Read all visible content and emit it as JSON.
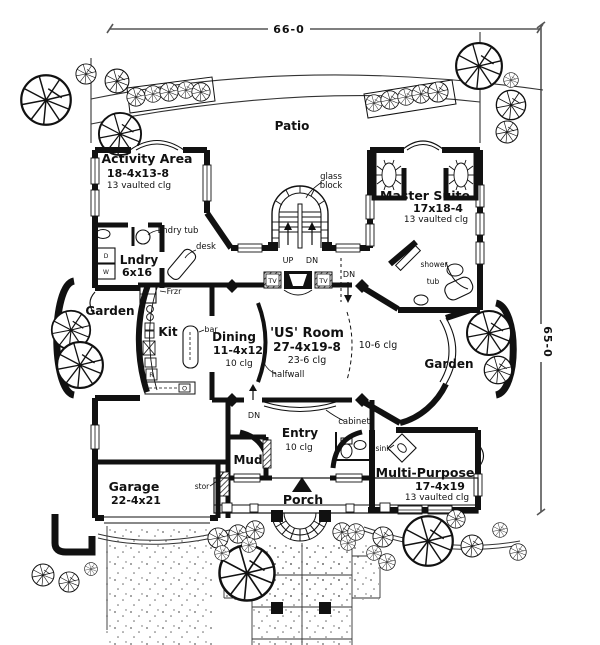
{
  "dimensions": {
    "top": "66-0",
    "right": "65-0"
  },
  "site": {
    "patio": "Patio"
  },
  "rooms": {
    "activity": {
      "name": "Activity Area",
      "size": "18-4x13-8",
      "ceiling": "13 vaulted clg"
    },
    "master": {
      "name": "Master Suite",
      "size": "17x18-4",
      "ceiling": "13 vaulted clg"
    },
    "lndry": {
      "name": "Lndry",
      "size": "6x16"
    },
    "garden_left": {
      "name": "Garden"
    },
    "garden_right": {
      "name": "Garden"
    },
    "kit": {
      "name": "Kit"
    },
    "dining": {
      "name": "Dining",
      "size": "11-4x12",
      "ceiling": "10 clg"
    },
    "us_room": {
      "name": "'US' Room",
      "size": "27-4x19-8",
      "ceiling": "23-6 clg"
    },
    "bay": {
      "ceiling": "10-6 clg"
    },
    "entry": {
      "name": "Entry",
      "ceiling": "10 clg"
    },
    "mud": {
      "name": "Mud"
    },
    "garage": {
      "name": "Garage",
      "size": "22-4x21"
    },
    "multi": {
      "name": "Multi-Purpose",
      "size": "17-4x19",
      "ceiling": "13 vaulted clg"
    },
    "porch": {
      "name": "Porch"
    }
  },
  "annotations": {
    "glass1": "glass",
    "glass2": "block",
    "up": "UP",
    "dn": "DN",
    "dn_right": "DN",
    "dn_bottom": "DN",
    "lndry_tub": "Lndry tub",
    "desk": "desk",
    "frzr": "Frzr",
    "bar": "bar",
    "halfwall": "halfwall",
    "cabinet": "cabinet",
    "sink": "sink",
    "stor": "stor",
    "shower": "shower",
    "tub": "tub",
    "tv": "TV",
    "washer": "W",
    "dryer": "D",
    "range": "R",
    "oven": "O"
  },
  "colors": {
    "ink": "#111111",
    "dim_line": "#555555",
    "stipple": "#666666"
  }
}
